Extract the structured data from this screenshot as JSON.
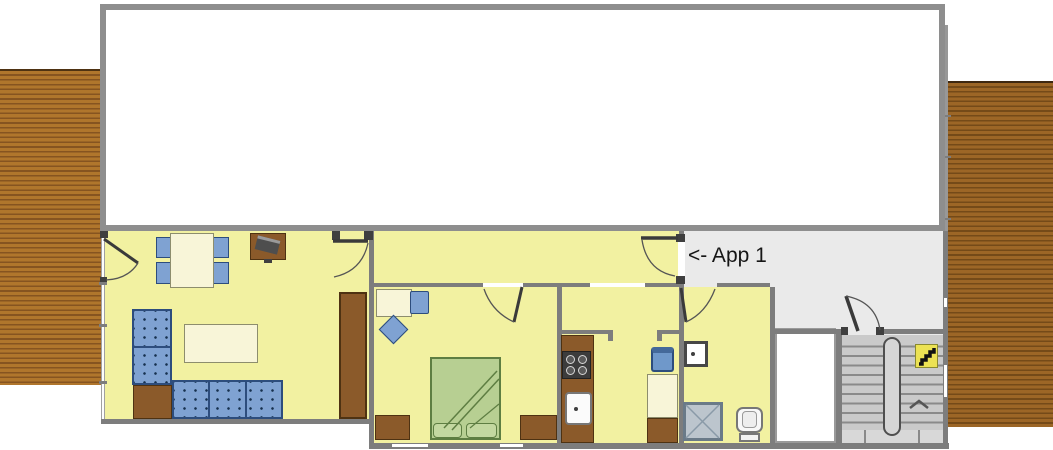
{
  "labels": {
    "app1": "<- App 1"
  },
  "colors": {
    "floor": "#f2f1a1",
    "landing": "#eaeaea",
    "wall": "#7d7d7d",
    "outline": "#8e8e8e",
    "deck_left": "#b0762c",
    "deck_left_stripe": "#865420",
    "deck_right": "#9c6626",
    "deck_right_stripe": "#744a18",
    "furniture_blue": "#7fa2d2",
    "furniture_blue_border": "#2d4d7d",
    "cream": "#f8f5d8",
    "wood": "#8b5a2a",
    "bed_green": "#b7cf92",
    "stairs_floor": "#cacaca",
    "sign_yellow": "#ece254"
  },
  "icons": {
    "stairs_sign": "stairs-icon",
    "up_arrow": "chevron-up-icon"
  }
}
